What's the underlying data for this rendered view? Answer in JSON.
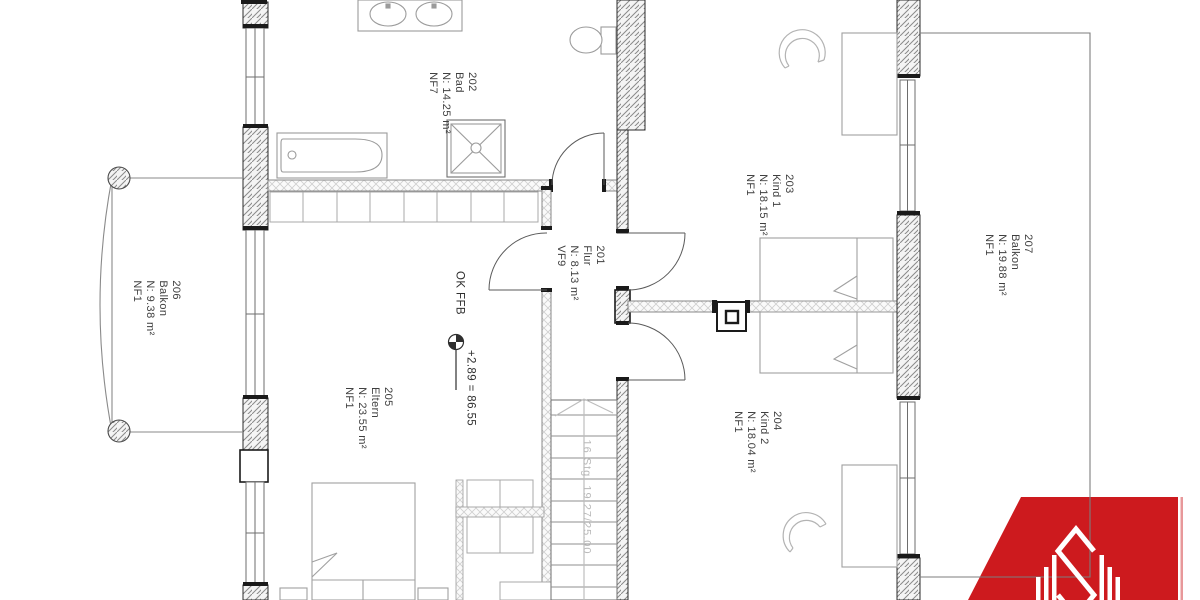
{
  "plan": {
    "title": "Obergeschoss Grundriss",
    "rooms": [
      {
        "number": "201",
        "name": "Flur",
        "area": "N: 8.13 m²",
        "code": "VF9"
      },
      {
        "number": "202",
        "name": "Bad",
        "area": "N: 14.25 m²",
        "code": "NF7"
      },
      {
        "number": "203",
        "name": "Kind 1",
        "area": "N: 18.15 m²",
        "code": "NF1"
      },
      {
        "number": "204",
        "name": "Kind 2",
        "area": "N: 18.04 m²",
        "code": "NF1"
      },
      {
        "number": "205",
        "name": "Eltern",
        "area": "N: 23.55 m²",
        "code": "NF1"
      },
      {
        "number": "206",
        "name": "Balkon",
        "area": "N: 9.38 m²",
        "code": "NF1"
      },
      {
        "number": "207",
        "name": "Balkon",
        "area": "N: 19.88 m²",
        "code": "NF1"
      }
    ],
    "level_note": {
      "label": "OK FFB",
      "value": "+2.89  =  86.55"
    },
    "stair_note": "16 Stg. 19.27/25.00",
    "logo": {
      "monogram": "S",
      "color": "#cd1a1e"
    }
  }
}
